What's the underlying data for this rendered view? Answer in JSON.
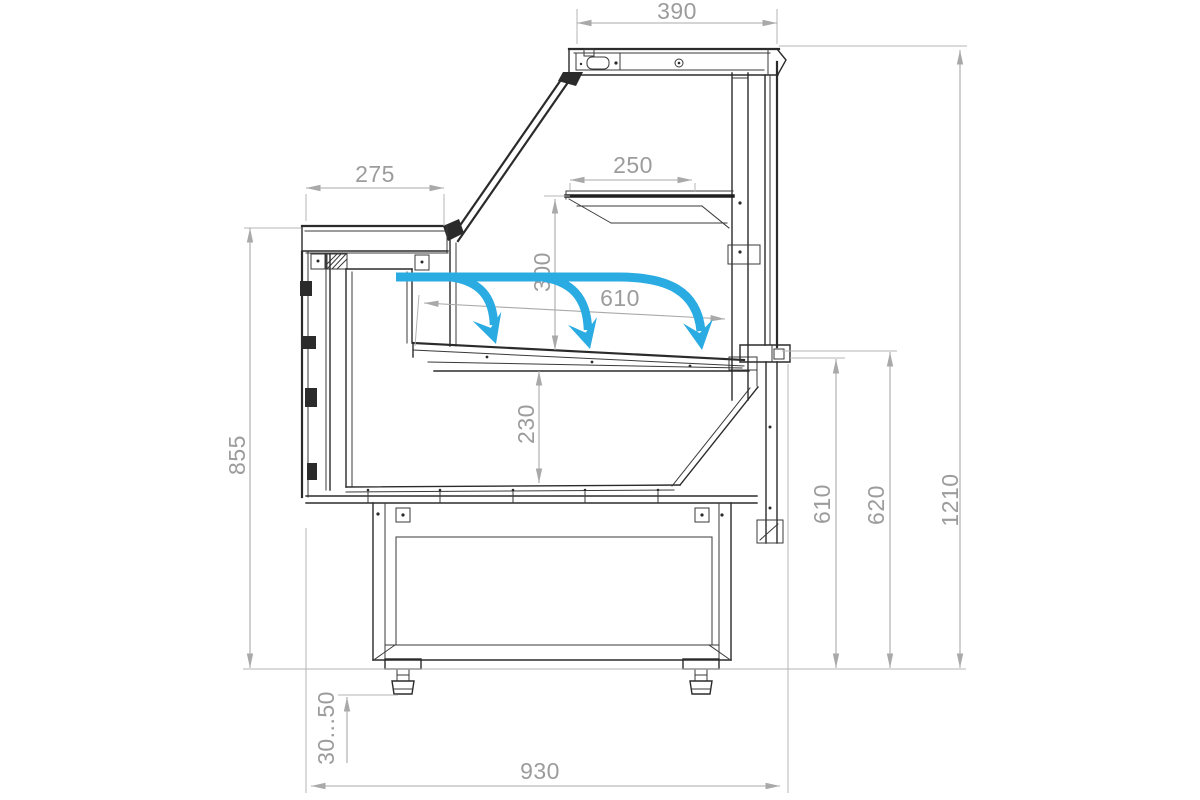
{
  "drawing": {
    "kind": "technical-drawing",
    "subject": "refrigerated serve-over display case — side cross-section with airflow",
    "dims": {
      "canopy_top": "390",
      "rear_counter": "275",
      "upper_shelf": "250",
      "shelf_to_deck": "300",
      "deck_length": "610",
      "deck_to_base": "230",
      "rear_counter_height": "855",
      "glass_bottom_height": "610",
      "front_shelf_height": "620",
      "overall_height": "1210",
      "feet_adjust_range": "30...50",
      "base_width": "930"
    },
    "colors": {
      "airflow_blue": "#2aabe2",
      "dimension_gray": "#9c9c9c",
      "line_dark": "#2b2b2b",
      "background": "#ffffff"
    }
  }
}
